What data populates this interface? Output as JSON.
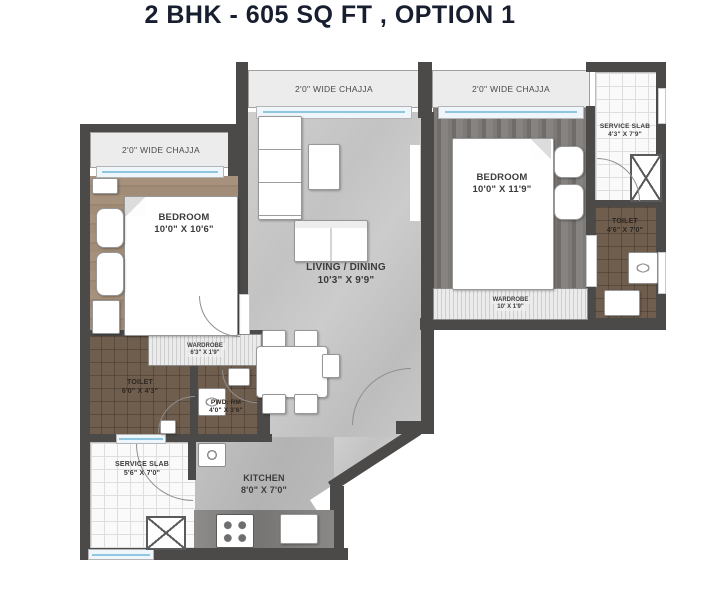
{
  "title": "2 BHK - 605 SQ FT , OPTION 1",
  "chajjas": [
    {
      "id": "left",
      "label": "2'0\" WIDE CHAJJA"
    },
    {
      "id": "middle",
      "label": "2'0\" WIDE CHAJJA"
    },
    {
      "id": "right",
      "label": "2'0\" WIDE CHAJJA"
    }
  ],
  "rooms": {
    "bedroom_left": {
      "name": "BEDROOM",
      "dims": "10'0\" X 10'6\""
    },
    "bedroom_right": {
      "name": "BEDROOM",
      "dims": "10'0\" X 11'9\""
    },
    "living_dining": {
      "name": "LIVING / DINING",
      "dims": "10'3\" X 9'9\""
    },
    "kitchen": {
      "name": "KITCHEN",
      "dims": "8'0\" X 7'0\""
    },
    "toilet_left": {
      "name": "TOILET",
      "dims": "6'0\" X 4'3\""
    },
    "toilet_right": {
      "name": "TOILET",
      "dims": "4'6\" X 7'0\""
    },
    "powder_room": {
      "name": "PWD. RM",
      "dims": "4'0\" X 3'6\""
    },
    "wardrobe_left": {
      "name": "WARDROBE",
      "dims": "6'3\" X 1'9\""
    },
    "wardrobe_right": {
      "name": "WARDROBE",
      "dims": "10' X 1'9\""
    },
    "service_slab_right": {
      "name": "SERVICE SLAB",
      "dims": "4'3\" X 7'9\""
    },
    "service_slab_bottom": {
      "name": "SERVICE SLAB",
      "dims": "5'6\" X 7'0\""
    }
  },
  "colors": {
    "wall": "#4b4a48",
    "window_blue": "#8fc6e0",
    "floor_living": "#c6c6c6",
    "floor_kitchen": "#b4b4b4",
    "floor_bedroom_left": "#a08b76",
    "floor_bedroom_right": "#767472",
    "floor_toilet": "#6f5d4e",
    "title_text": "#171e30"
  }
}
